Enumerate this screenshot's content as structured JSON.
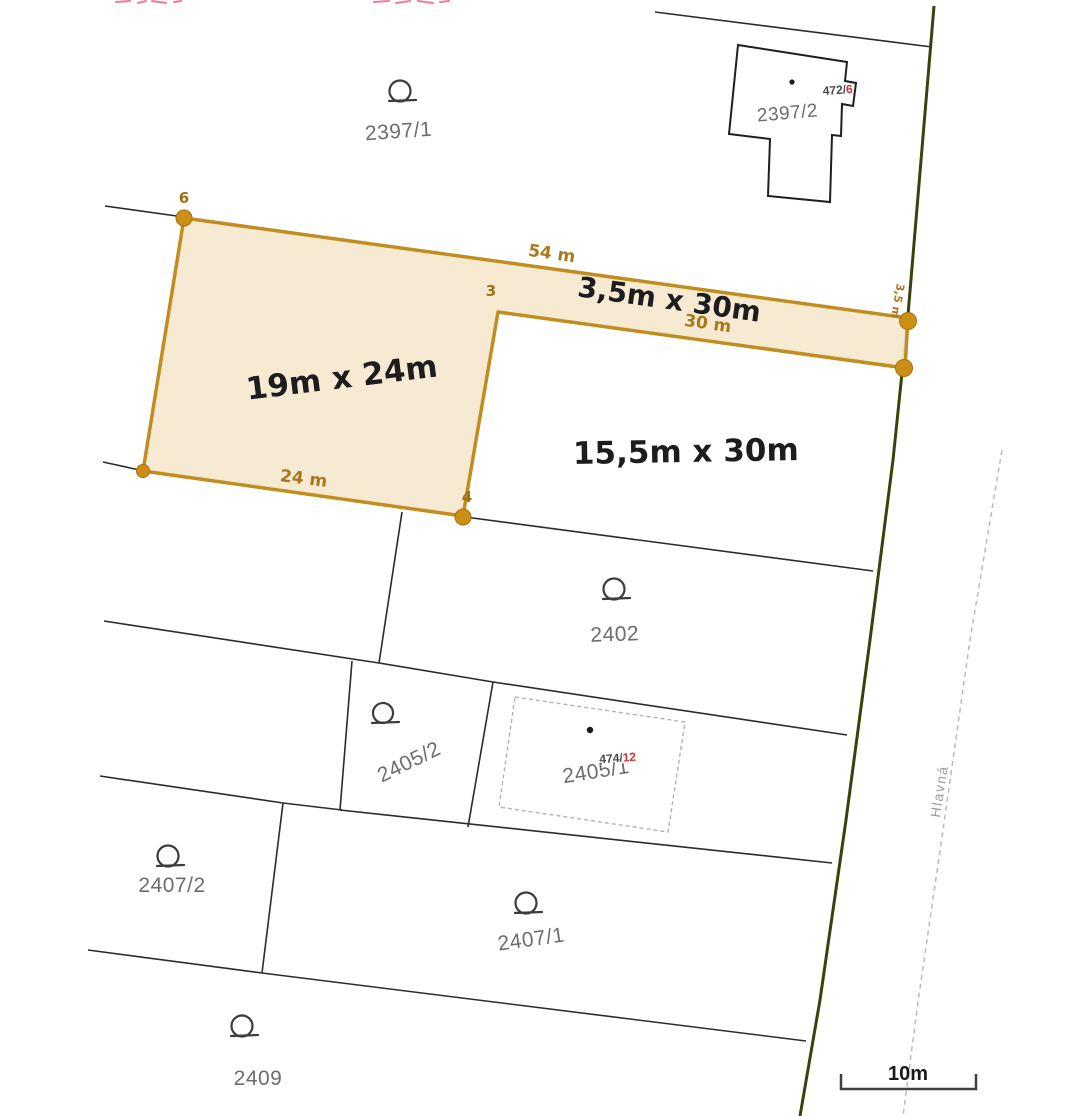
{
  "map": {
    "parcels": {
      "p2397_1": "2397/1",
      "p2397_2": "2397/2",
      "p2402": "2402",
      "p2405_2": "2405/2",
      "p2405_1": "2405/1",
      "p2407_2": "2407/2",
      "p2407_1": "2407/1",
      "p2409": "2409"
    },
    "buildings": {
      "b472_prefix": "472/",
      "b472_red": "6",
      "b474_prefix": "474/",
      "b474_red": "12"
    },
    "highlight": {
      "dim_main": "19m x 24m",
      "dim_strip": "3,5m x 30m",
      "dim_side": "15,5m x 30m",
      "edge_top": "54 m",
      "edge_strip": "30 m",
      "edge_bottom": "24 m",
      "edge_right": "3,5 m",
      "vertex_3": "3",
      "vertex_4": "4",
      "vertex_6": "6"
    },
    "road": {
      "name": "Hlavná"
    },
    "scale": {
      "label": "10m"
    },
    "colors": {
      "highlight_fill": "#f6e8cf",
      "highlight_border": "#c18d1e",
      "vertex_dot": "#cc8f14",
      "dim_text": "#1d1d1f",
      "edge_label": "#a9781b",
      "parcel_label": "#6d6d6d",
      "boundary": "#2b2b2b",
      "road_line": "#38430c",
      "road_centerline": "#bbbbbb",
      "red_number": "#d23434"
    }
  }
}
